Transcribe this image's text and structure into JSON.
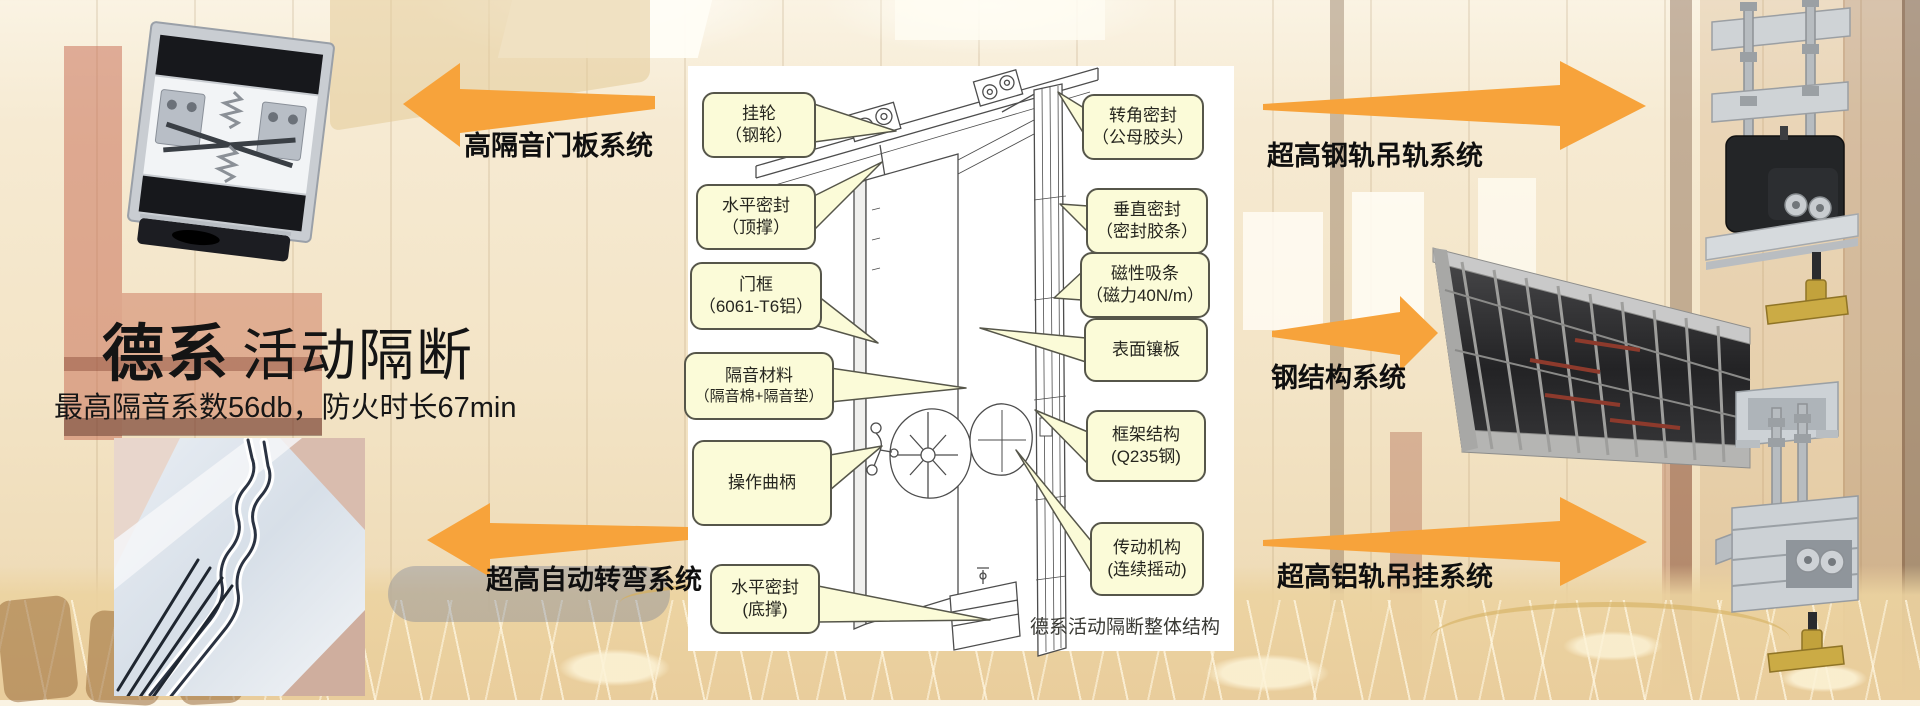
{
  "slide": {
    "title_primary": "德系",
    "title_secondary": "活动隔断",
    "subtitle": "最高隔音系数56db，防火时长67min",
    "diagram_caption": "德系活动隔断整体结构"
  },
  "system_labels": {
    "door_panel": "高隔音门板系统",
    "auto_turning": "超高自动转弯系统",
    "steel_rail": "超高钢轨吊轨系统",
    "steel_structure": "钢结构系统",
    "aluminum_rail": "超高铝轨吊挂系统"
  },
  "callouts": {
    "left": [
      {
        "line1": "挂轮",
        "line2": "（钢轮）"
      },
      {
        "line1": "水平密封",
        "line2": "（顶撑）"
      },
      {
        "line1": "门框",
        "line2": "（6061-T6铝）"
      },
      {
        "line1": "隔音材料",
        "line2": "（隔音棉+隔音垫）"
      },
      {
        "line1": "操作曲柄",
        "line2": ""
      },
      {
        "line1": "水平密封",
        "line2": "(底撑)"
      }
    ],
    "right": [
      {
        "line1": "转角密封",
        "line2": "（公母胶头）"
      },
      {
        "line1": "垂直密封",
        "line2": "（密封胶条）"
      },
      {
        "line1": "磁性吸条",
        "line2": "（磁力40N/m）"
      },
      {
        "line1": "表面镶板",
        "line2": ""
      },
      {
        "line1": "框架结构",
        "line2": "(Q235钢)"
      },
      {
        "line1": "传动机构",
        "line2": "(连续摇动)"
      }
    ]
  },
  "colors": {
    "arrow_orange": "#F7A33B",
    "callout_fill": "#FBFBD8",
    "callout_border": "#56564A",
    "background_cream": "#F3E6CC"
  }
}
